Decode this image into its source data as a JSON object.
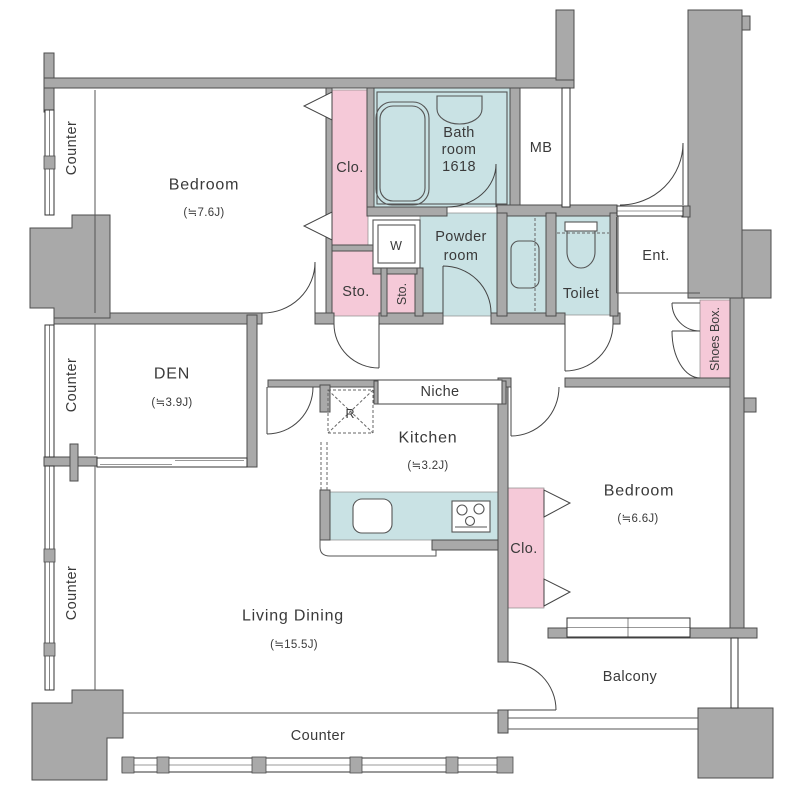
{
  "colors": {
    "wall_fill": "#a9a9a9",
    "wall_line": "#4d4d4d",
    "closet_pink": "#f5c9d8",
    "wet_area_blue": "#c9e2e4",
    "text": "#3a3a3a",
    "background": "#ffffff"
  },
  "rooms": {
    "bedroom1": {
      "name": "Bedroom",
      "size": "(≒7.6J)"
    },
    "bedroom2": {
      "name": "Bedroom",
      "size": "(≒6.6J)"
    },
    "den": {
      "name": "DEN",
      "size": "(≒3.9J)"
    },
    "living_dining": {
      "name": "Living Dining",
      "size": "(≒15.5J)"
    },
    "kitchen": {
      "name": "Kitchen",
      "size": "(≒3.2J)"
    },
    "bathroom": {
      "line1": "Bath",
      "line2": "room",
      "line3": "1618"
    },
    "powder_room": {
      "line1": "Powder",
      "line2": "room"
    },
    "toilet": {
      "name": "Toilet"
    },
    "entrance": {
      "name": "Ent."
    },
    "meter_box": {
      "name": "MB"
    },
    "niche": {
      "name": "Niche"
    },
    "balcony": {
      "name": "Balcony"
    },
    "closet1": {
      "label": "Clo."
    },
    "closet2": {
      "label": "Clo."
    },
    "storage1": {
      "label": "Sto."
    },
    "storage2": {
      "label": "Sto."
    },
    "shoes_box": {
      "label": "Shoes Box."
    },
    "washer": {
      "label": "W"
    },
    "refrigerator": {
      "label": "R"
    }
  },
  "labels": {
    "counter_left_top": "Counter",
    "counter_left_middle": "Counter",
    "counter_left_bottom": "Counter",
    "counter_bottom": "Counter"
  }
}
